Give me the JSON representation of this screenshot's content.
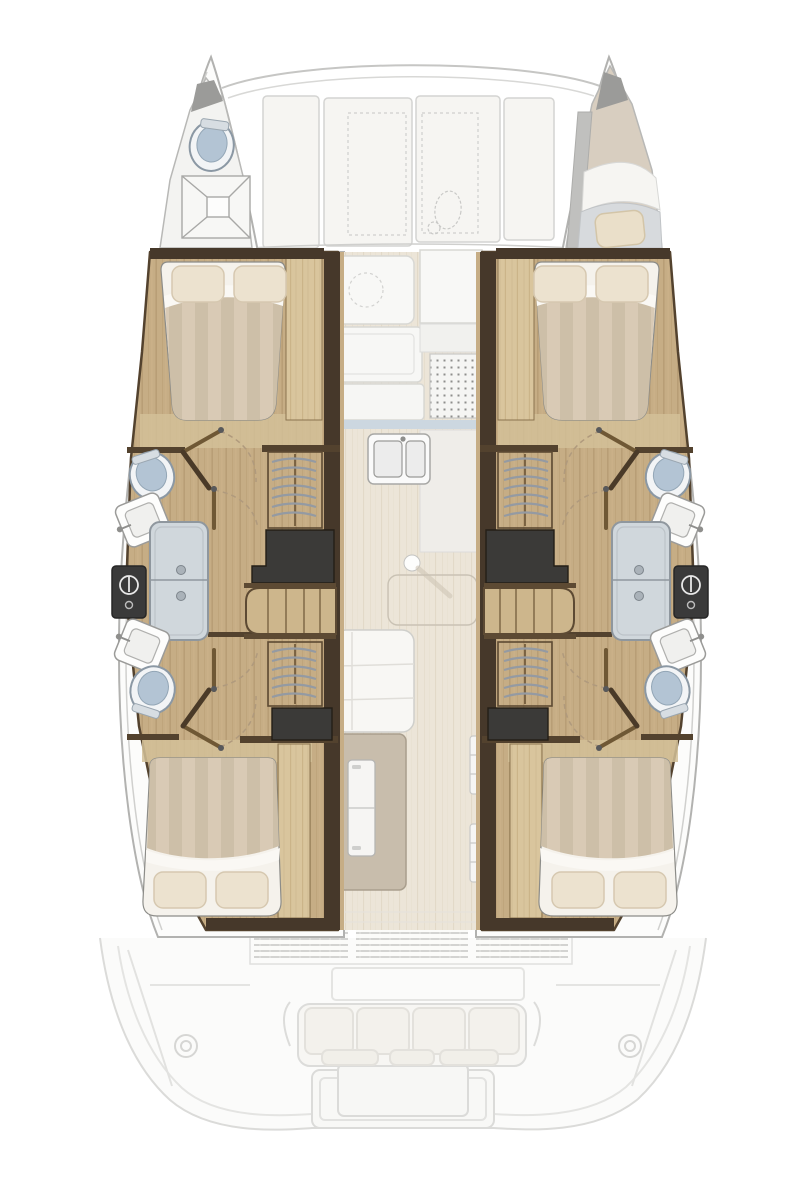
{
  "diagram": {
    "title": "Catamaran interior layout plan — top-down view",
    "type": "boat-floorplan",
    "view": "top-down",
    "cabin_count": "4",
    "head_count": "4",
    "colors": {
      "hull_stroke": "#b2b2b0",
      "deck_white": "#f6f5f2",
      "wood_floor": "#c6ad85",
      "wood_light_panel": "#d9c59d",
      "wall_dark_wood": "#46382a",
      "charcoal_cabinet": "#3b3a38",
      "salon_floor": "#ece5d8",
      "duvet_stripe_a": "#d9cab5",
      "duvet_stripe_b": "#cdbfa8",
      "pillow": "#eadfcd",
      "shower_pan": "#d0d7dc",
      "toilet_lid": "#b3c4d4",
      "counter_white": "#f8f8f6",
      "counter_blue_trim": "#ccd7e0",
      "cabinet_beige": "#c8bdac",
      "faint_cockpit_line": "#dbdbd9"
    },
    "areas": [
      {
        "id": "port-bow-head",
        "label": "Port bow head with toilet and shower pan"
      },
      {
        "id": "starboard-bow-berth",
        "label": "Starboard bow berth with cushion and pillow"
      },
      {
        "id": "foredeck",
        "label": "Foredeck with deck hatches and windlass"
      },
      {
        "id": "port-forward-cabin",
        "label": "Port forward double cabin"
      },
      {
        "id": "port-forward-bathroom",
        "label": "Port forward bathroom with toilet, sink and shower"
      },
      {
        "id": "port-aft-bathroom",
        "label": "Port aft bathroom with toilet, sink and shower"
      },
      {
        "id": "port-aft-cabin",
        "label": "Port aft double cabin"
      },
      {
        "id": "starboard-hull-interior",
        "label": "Starboard hull: two cabins and two bathrooms (mirror of port)"
      },
      {
        "id": "galley",
        "label": "Central galley with counters, stove grate and double sink"
      },
      {
        "id": "salon",
        "label": "Salon walkway with floor hatch and table post"
      },
      {
        "id": "settee",
        "label": "Salon settee and cabinet with refrigerator"
      },
      {
        "id": "cockpit",
        "label": "Aft cockpit bench with cushions"
      },
      {
        "id": "cockpit-table",
        "label": "Cockpit table"
      },
      {
        "id": "transom",
        "label": "Transom platform and swim steps"
      }
    ],
    "fixtures": [
      {
        "id": "toilet",
        "label": "Toilet"
      },
      {
        "id": "sink",
        "label": "Wash basin"
      },
      {
        "id": "shower-pan",
        "label": "Shower pan with controls"
      },
      {
        "id": "shower-control",
        "label": "Shower mixer panel"
      },
      {
        "id": "wardrobe-hangers",
        "label": "Hanging wardrobe"
      },
      {
        "id": "companionway-steps",
        "label": "Companionway steps"
      },
      {
        "id": "double-bed",
        "label": "Double bed with striped duvet and pillows"
      },
      {
        "id": "fridge",
        "label": "Refrigerator"
      },
      {
        "id": "deck-hatch",
        "label": "Deck hatch (dashed)"
      },
      {
        "id": "windlass",
        "label": "Anchor windlass (dashed)"
      },
      {
        "id": "winch",
        "label": "Cockpit winch"
      }
    ]
  }
}
